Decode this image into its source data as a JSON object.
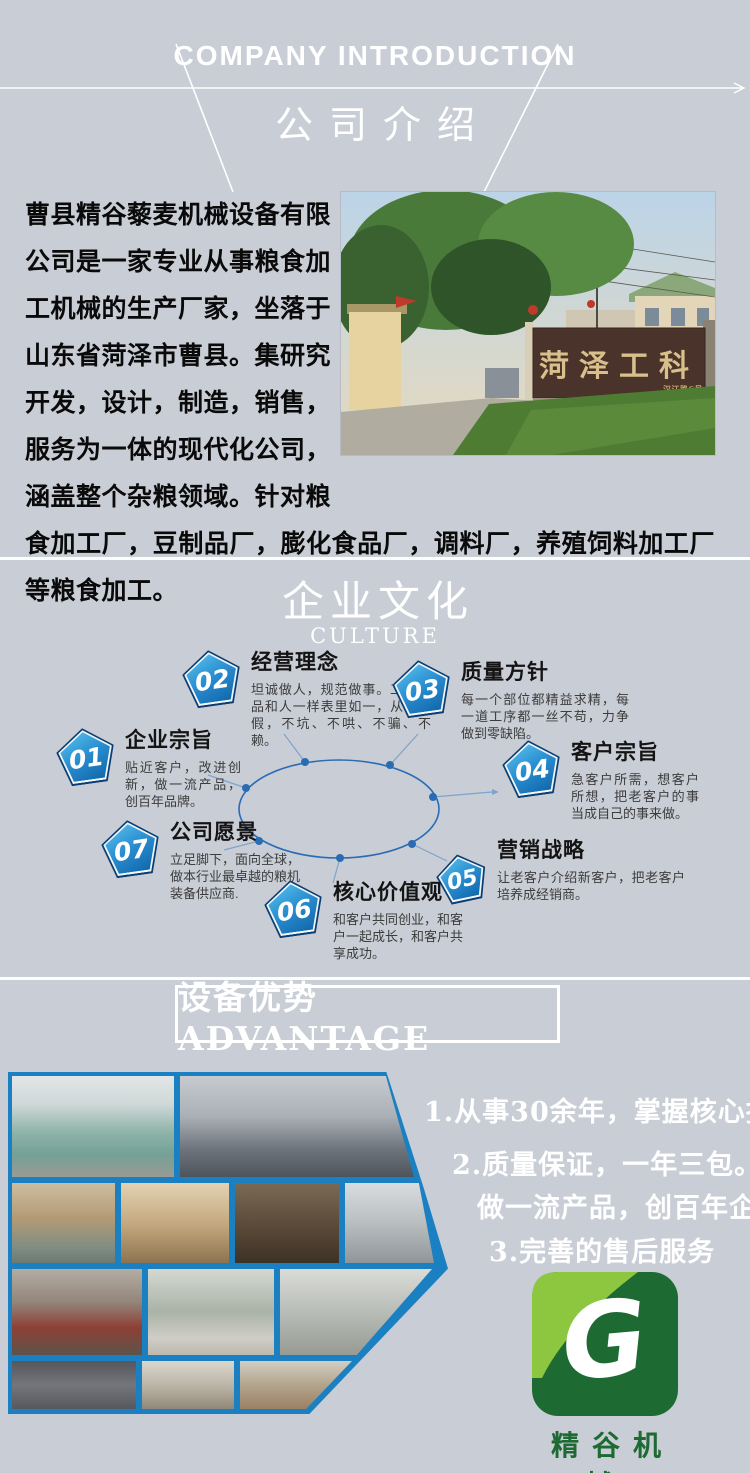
{
  "header": {
    "en_title": "COMPANY INTRODUCTION",
    "cn_title": "公司介绍"
  },
  "intro": {
    "paragraph": "曹县精谷藜麦机械设备有限公司是一家专业从事粮食加工机械的生产厂家，坐落于山东省菏泽市曹县。集研究开发，设计，制造，销售，服务为一体的现代化公司，涵盖整个杂粮领域。针对粮食加工厂，豆制品厂，膨化食品厂，调料厂，养殖饲料加工厂等粮食加工。",
    "gate_photo": {
      "sign_text": "菏泽工科",
      "sign_subtext": "汉江路6号"
    }
  },
  "culture": {
    "cn_title": "企业文化",
    "en_title": "CULTURE",
    "items": [
      {
        "number": "01",
        "title": "企业宗旨",
        "desc": "贴近客户，改进创新，做一流产品，创百年品牌。"
      },
      {
        "number": "02",
        "title": "经营理念",
        "desc": "坦诚做人，规范做事。工科产品和人一样表里如一，从不掺假，不坑、不哄、不骗、不赖。"
      },
      {
        "number": "03",
        "title": "质量方针",
        "desc": "每一个部位都精益求精，每一道工序都一丝不苟，力争做到零缺陷。"
      },
      {
        "number": "04",
        "title": "客户宗旨",
        "desc": "急客户所需，想客户所想，把老客户的事当成自己的事来做。"
      },
      {
        "number": "05",
        "title": "营销战略",
        "desc": "让老客户介绍新客户，把老客户培养成经销商。"
      },
      {
        "number": "06",
        "title": "核心价值观",
        "desc": "和客户共同创业，和客户一起成长，和客户共享成功。"
      },
      {
        "number": "07",
        "title": "公司愿景",
        "desc": "立足脚下，面向全球，做本行业最卓越的粮机装备供应商."
      }
    ]
  },
  "advantage": {
    "banner": "设备优势 ADVANTAGE",
    "points": [
      "1.从事30余年，掌握核心技术，",
      "2.质量保证，一年三包。",
      "做一流产品，创百年企业",
      "3.完善的售后服务"
    ]
  },
  "logo": {
    "letter": "G",
    "brand": "精谷机械"
  },
  "colors": {
    "background": "#c9cdd5",
    "accent_blue": "#2a6cb3",
    "collage_border_blue": "#1b80c2",
    "pentagon_light_blue": "#59c4f0",
    "pentagon_dark_blue": "#0e63a8",
    "logo_light_green": "#8dc63f",
    "logo_dark_green": "#1d6a32",
    "gate_sign_brown": "#4a332a",
    "gate_sign_gold": "#d9c08b"
  }
}
